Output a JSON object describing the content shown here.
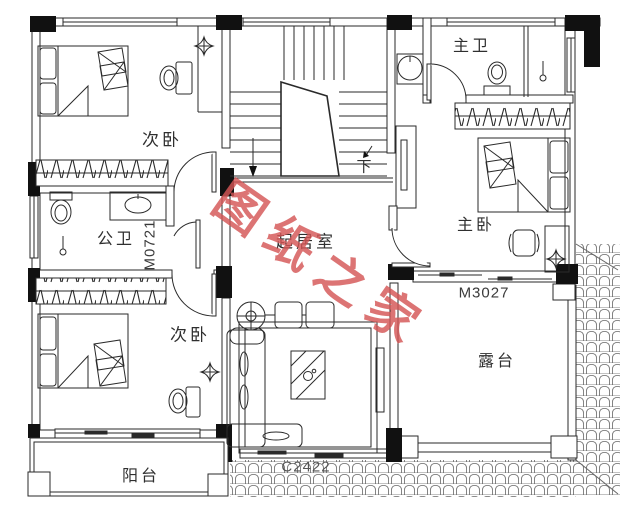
{
  "watermark": {
    "text": "图纸之家",
    "color": "#d45656"
  },
  "rooms": {
    "bedroom_top_left": {
      "label": "次卧"
    },
    "public_bath": {
      "label": "公卫"
    },
    "bedroom_bottom_left": {
      "label": "次卧"
    },
    "balcony": {
      "label": "阳台"
    },
    "living_room": {
      "label": "起居室"
    },
    "master_bath": {
      "label": "主卫"
    },
    "master_bedroom": {
      "label": "主卧"
    },
    "terrace": {
      "label": "露台"
    }
  },
  "doors": {
    "m0721": "M0721",
    "m3027": "M3027"
  },
  "windows": {
    "c2422": "C2422"
  },
  "stairs": {
    "down_label": "下"
  },
  "colors": {
    "line": "#2a2a2a",
    "tile_line": "#666666"
  }
}
